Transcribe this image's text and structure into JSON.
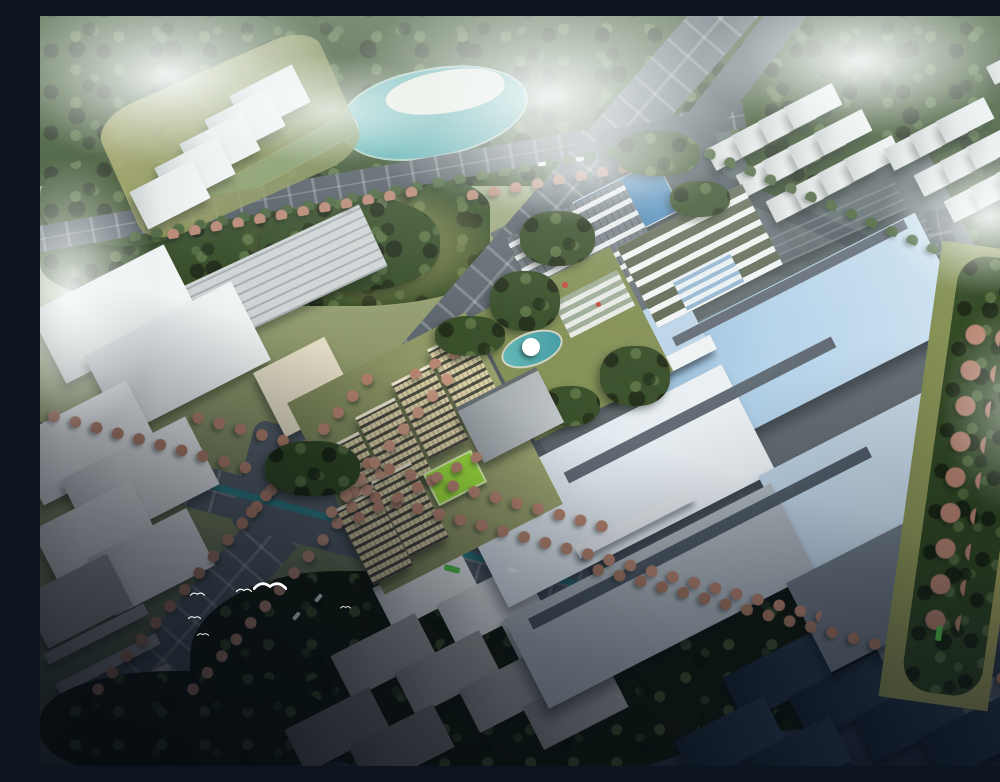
{
  "scene": {
    "aria_label": "Aerial architectural rendering of an industrial park campus: white factory halls with pale blue roofs, blue entrance gate building, parking lots, six tan dormitory blocks with a bright green sports field, central garden with pond, teal lake and canal in a riverside park, tree-lined boulevards with autumn-pink street trees, clusters of white context warehouses, dark evening forest in the foreground and white birds flying over the road",
    "type": "architectural-aerial-rendering",
    "view": "high oblique bird's-eye",
    "atmosphere": "daytime mist and low clouds, dark shadow across foreground"
  },
  "palette": {
    "haze": "#c9d4d1",
    "forestDark": "#17230f",
    "forestMid": "#2e451f",
    "forestLight": "#51693a",
    "olive": "#7c8a4e",
    "grassSun": "#a8a55c",
    "fieldGreen": "#9ade35",
    "water": "#46a4a8",
    "waterDark": "#2e8189",
    "road": "#566069",
    "roadDark": "#49525b",
    "white": "#eef1f1",
    "cream": "#e7dfc8",
    "roofBlue": "#a9cbe6",
    "roofPale": "#dfe8ef",
    "gateBlue": "#3c7cb4",
    "towerTan": "#d6cba0",
    "salmon": "#b5816c",
    "navy": "#1b2a3c",
    "cloud": "#f7faf9",
    "bus": "#55c84a"
  },
  "inventory": {
    "factory_halls": 6,
    "dormitory_towers": 6,
    "entrance_gate_buildings": 1,
    "parking_lots": 2,
    "sports_fields": 1,
    "lakes": 1,
    "canals": 2,
    "context_building_blocks": 65,
    "birds": 6,
    "buses": 2,
    "cloud_patches": 8
  },
  "features": [
    "misty forest horizon",
    "teal lake with white sand island",
    "riverside park with canal",
    "tree-lined boulevards with autumn-pink trees",
    "large factory halls with pale-blue striped roofs",
    "blue-roofed entrance gate",
    "rows of parked white cars",
    "tan dormitory blocks",
    "bright green soccer field",
    "central garden with pond and white pavilion",
    "white warehouse clusters",
    "dark evening shadow over foreground",
    "white birds in flight"
  ]
}
